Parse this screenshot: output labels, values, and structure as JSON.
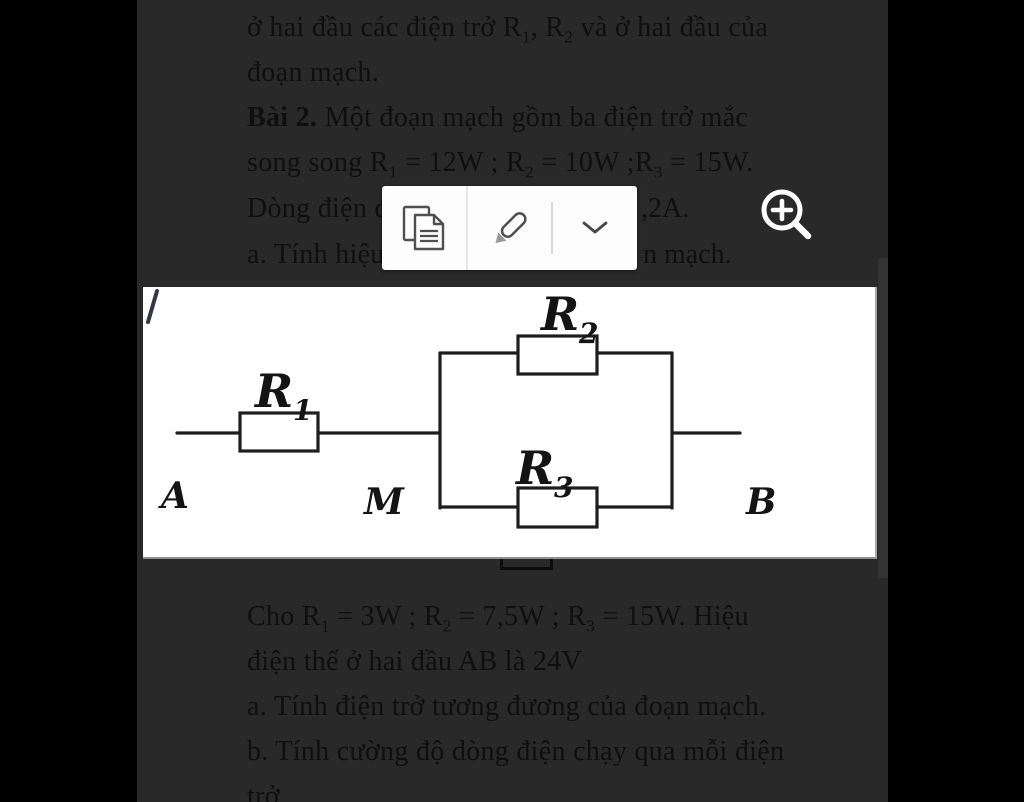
{
  "colors": {
    "backdrop": "#000000",
    "page_dimmed": "#292929",
    "ink": "#0f0f0f",
    "toolbar_bg": "#fdfdfd",
    "icon_stroke": "#4f4f4f",
    "figure_bg": "#ffffff",
    "circuit_stroke": "#1d1d1d",
    "magnifier": "#ffffff"
  },
  "document": {
    "line1": "ở hai đầu các điện trở R_1, R_2 và ở hai đầu của",
    "line2": "đoạn mạch.",
    "line3_bold": "Bài 2.",
    "line3_rest": " Một đoạn mạch gồm ba điện trở mắc",
    "line4": "song song R_1 = 12W ; R_2 = 10W ;R_3 = 15W.",
    "line5_left": "Dòng điện đ",
    "line5_right": ",2A.",
    "line6_left": "a. Tính hiệu",
    "line6_right": "n mạch.",
    "line7": "Cho R_1 = 3W ; R_2 = 7,5W ; R_3 = 15W. Hiệu",
    "line8": "điện thế ở hai đầu AB là 24V",
    "line9": "a. Tính điện trở tương đương của đoạn mạch.",
    "line10": "b. Tính cường độ dòng điện chạy qua mỗi điện",
    "line11": "trở"
  },
  "toolbar": {
    "buttons": [
      {
        "name": "copy",
        "icon": "copy-icon"
      },
      {
        "name": "highlight",
        "icon": "highlighter-icon"
      },
      {
        "name": "more",
        "icon": "chevron-down-icon"
      }
    ]
  },
  "magnifier": {
    "icon": "zoom-in-icon"
  },
  "figure": {
    "type": "circuit-diagram",
    "description": "R1 in series with parallel pair R2 and R3 between terminals A, M, B",
    "labels": {
      "r1": {
        "main": "R",
        "sub": "1"
      },
      "r2": {
        "main": "R",
        "sub": "2"
      },
      "r3": {
        "main": "R",
        "sub": "3"
      },
      "node_a": "A",
      "node_m": "M",
      "node_b": "B"
    }
  }
}
